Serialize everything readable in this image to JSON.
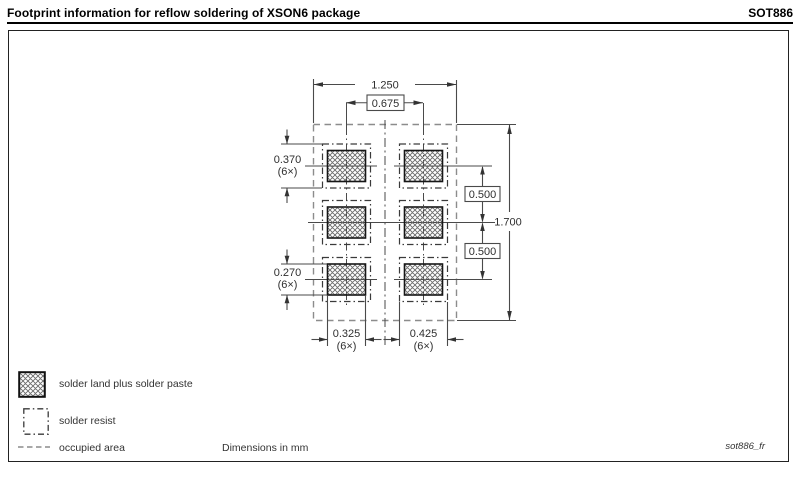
{
  "header": {
    "title": "Footprint information for reflow soldering of XSON6 package",
    "package_code": "SOT886"
  },
  "drawing": {
    "dim_overall_width": "1.250",
    "dim_pitch_x": "0.675",
    "dim_resist_height": "0.370",
    "dim_resist_height_qty": "(6×)",
    "dim_land_height": "0.270",
    "dim_land_height_qty": "(6×)",
    "dim_pitch_y_top": "0.500",
    "dim_pitch_y_bottom": "0.500",
    "dim_overall_height": "1.700",
    "dim_land_width": "0.325",
    "dim_land_width_qty": "(6×)",
    "dim_resist_width": "0.425",
    "dim_resist_width_qty": "(6×)"
  },
  "legend": {
    "solder_land": "solder land plus solder paste",
    "solder_resist": "solder resist",
    "occupied_area": "occupied area"
  },
  "footer": {
    "units_note": "Dimensions in mm",
    "drawing_ref": "sot886_fr"
  },
  "colors": {
    "background": "#ffffff",
    "outline": "#1a1a1a",
    "dimension_line": "#4a4a4a",
    "hatch": "#6a6a6a",
    "occupied_dash": "#8c8c8c"
  }
}
